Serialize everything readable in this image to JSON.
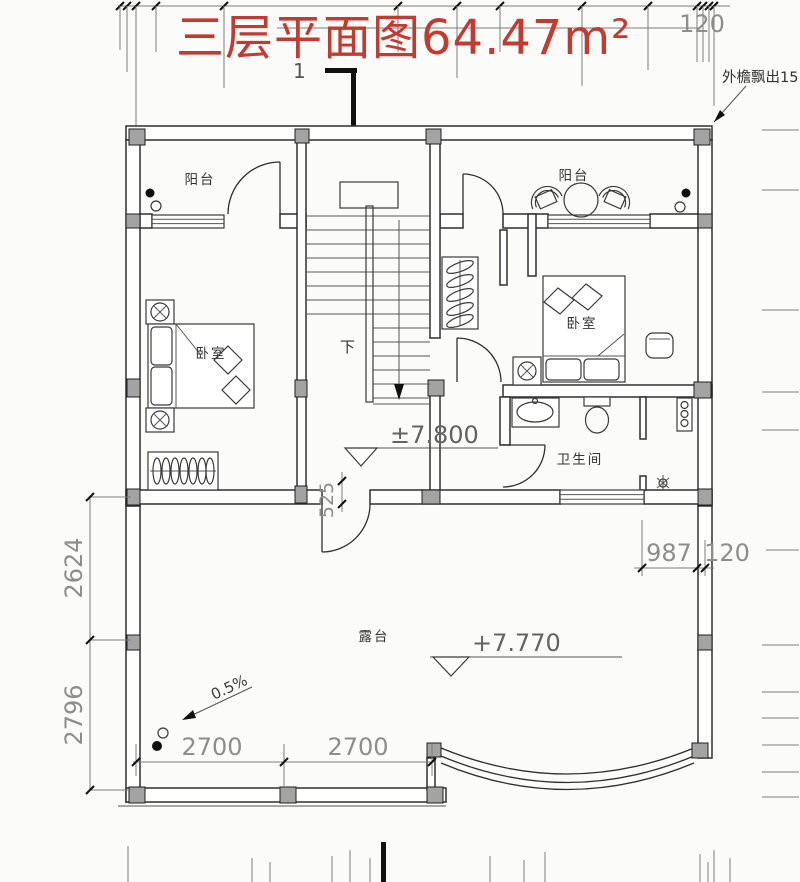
{
  "title": {
    "text": "三层平面图64.47m²",
    "color": "#c43a31"
  },
  "annotations": {
    "eave_note": "外檐飘出15",
    "section_top": "1",
    "down": "下",
    "slope": "0.5%",
    "level_floor": "±7.800",
    "level_terrace": "+7.770"
  },
  "rooms": {
    "balcony_left": "阳台",
    "balcony_right": "阳台",
    "bedroom_left": "卧室",
    "bedroom_right": "卧室",
    "bathroom": "卫生间",
    "terrace": "露台"
  },
  "dims": {
    "top_120": "120",
    "left_2624": "2624",
    "left_2796": "2796",
    "bottom_2700_a": "2700",
    "bottom_2700_b": "2700",
    "right_987": "987",
    "right_120": "120",
    "door_525": "525"
  },
  "palette": {
    "line": "#2f2f2f",
    "dimension_text": "#8d8d8d",
    "column_fill": "#a3a3a3",
    "title_red": "#c43a31",
    "background": "#fbfbf9"
  }
}
